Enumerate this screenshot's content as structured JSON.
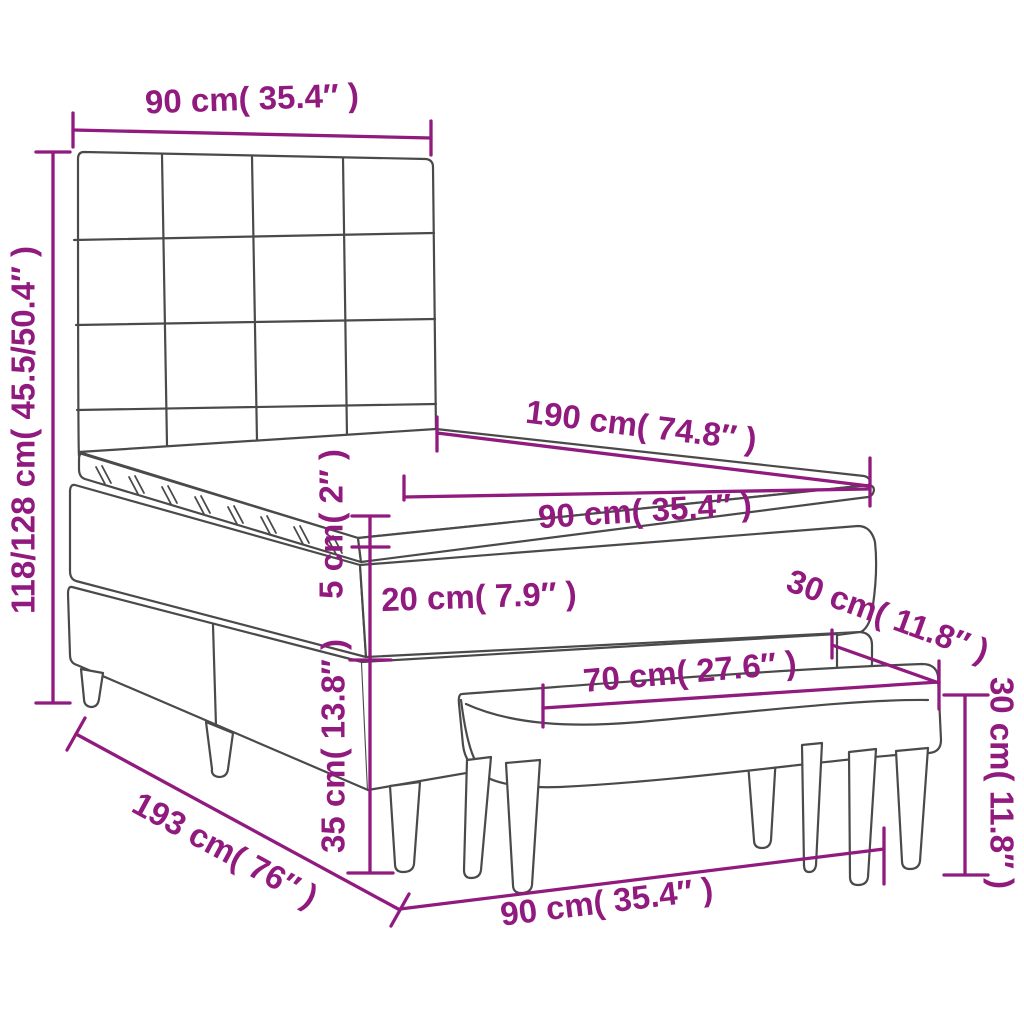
{
  "diagram": {
    "type": "product-dimension-diagram",
    "subject": "box-spring-bed-with-headboard-and-bench",
    "background": "#ffffff",
    "accent_color": "#901a7e",
    "line_color": "#4a4a4a",
    "dimensions": {
      "headboard_width": "90 cm( 35.4″ )",
      "overall_height": "118/128 cm( 45.5/50.4″ )",
      "bed_length": "190 cm( 74.8″ )",
      "mattress_width": "90 cm( 35.4″ )",
      "topper_thickness": "5 cm( 2″ )",
      "mattress_thickness": "20 cm( 7.9″ )",
      "bench_depth": "30 cm( 11.8″ )",
      "bench_length": "70 cm( 27.6″ )",
      "bench_height": "30 cm( 11.8″ )",
      "base_height": "35 cm( 13.8″ )",
      "base_length": "193 cm( 76″ )",
      "base_width": "90 cm( 35.4″ )"
    }
  }
}
